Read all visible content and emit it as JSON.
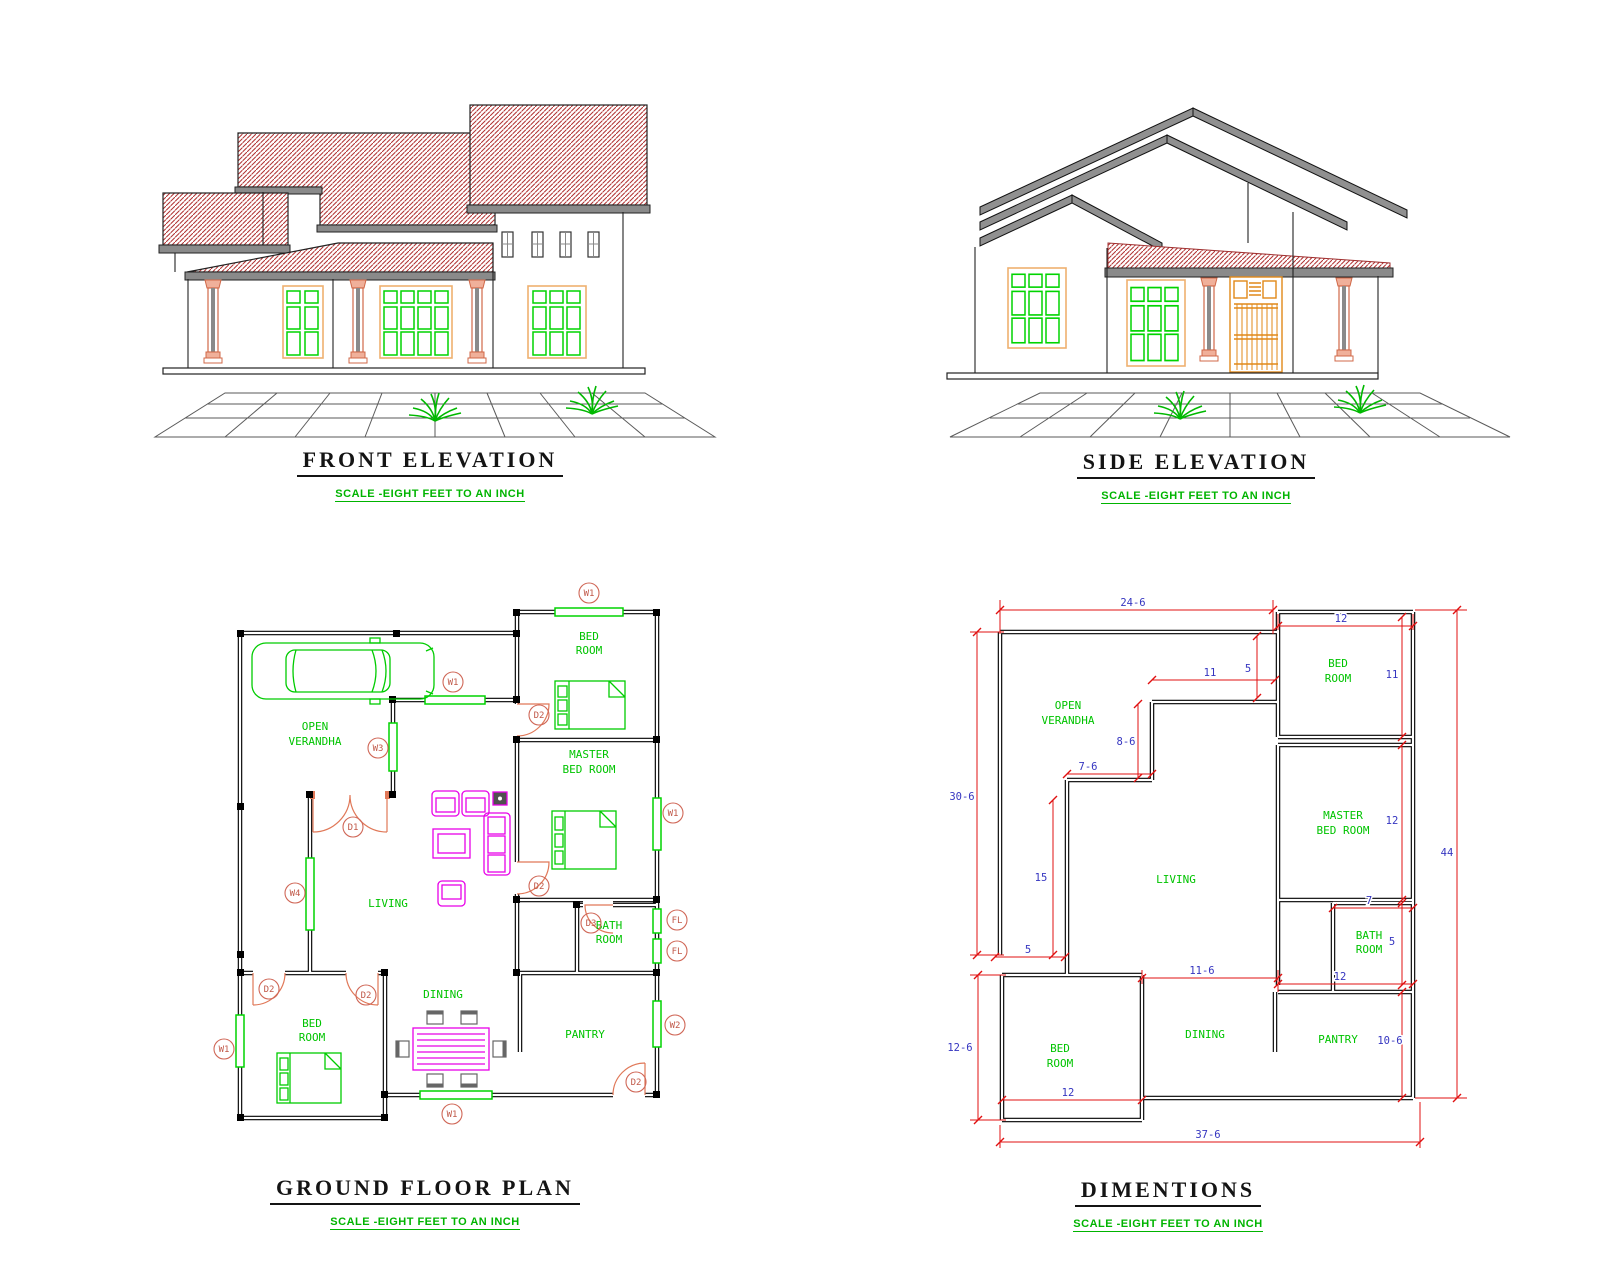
{
  "colors": {
    "wall_black": "#000000",
    "window_green": "#00d400",
    "label_green": "#00c400",
    "scale_green": "#00b400",
    "door_salmon": "#e07858",
    "dim_line_red": "#e01010",
    "dim_text_blue": "#3535c0",
    "roof_hatch_red": "#b03030",
    "fascia_gray": "#8a8a8a",
    "window_frame_tan": "#eeb070",
    "gate_orange": "#e08818",
    "furniture_magenta": "#e800e8"
  },
  "panels": {
    "front": {
      "title": "FRONT ELEVATION",
      "scale": "SCALE -EIGHT FEET TO AN INCH"
    },
    "side": {
      "title": "SIDE ELEVATION",
      "scale": "SCALE -EIGHT FEET TO AN INCH"
    },
    "plan": {
      "title": "GROUND FLOOR PLAN",
      "scale": "SCALE -EIGHT FEET TO AN INCH"
    },
    "dims": {
      "title": "DIMENTIONS",
      "scale": "SCALE -EIGHT FEET TO AN INCH"
    }
  },
  "fp": {
    "rooms": {
      "open1": "OPEN",
      "open2": "VERANDHA",
      "bed_top1": "BED",
      "bed_top2": "ROOM",
      "master1": "MASTER",
      "master2": "BED ROOM",
      "living": "LIVING",
      "bath1": "BATH",
      "bath2": "ROOM",
      "dining": "DINING",
      "pantry": "PANTRY",
      "bed_bot1": "BED",
      "bed_bot2": "ROOM"
    },
    "mk": {
      "w1": "W1",
      "w2": "W2",
      "w3": "W3",
      "w4": "W4",
      "d1": "D1",
      "d2": "D2",
      "d3": "D3",
      "fl": "FL"
    }
  },
  "dm": {
    "rooms": {
      "open1": "OPEN",
      "open2": "VERANDHA",
      "bed_top1": "BED",
      "bed_top2": "ROOM",
      "master1": "MASTER",
      "master2": "BED ROOM",
      "living": "LIVING",
      "bath1": "BATH",
      "bath2": "ROOM",
      "dining": "DINING",
      "pantry": "PANTRY",
      "bed_bot1": "BED",
      "bed_bot2": "ROOM"
    },
    "v": {
      "top_w": "24-6",
      "bed_w": "12",
      "left_h": "30-6",
      "living_top": "11",
      "veranda_d": "5",
      "step_v": "8-6",
      "step_h": "7-6",
      "living_left": "15",
      "left_small": "5",
      "bed2_left": "12-6",
      "dining_w": "11-6",
      "pantry_top": "12",
      "bath_w": "7",
      "bed_h": "11",
      "master_h": "12",
      "bath_h": "5",
      "pantry_h": "10-6",
      "bed2_w": "12",
      "total_w": "37-6",
      "total_h": "44"
    }
  }
}
